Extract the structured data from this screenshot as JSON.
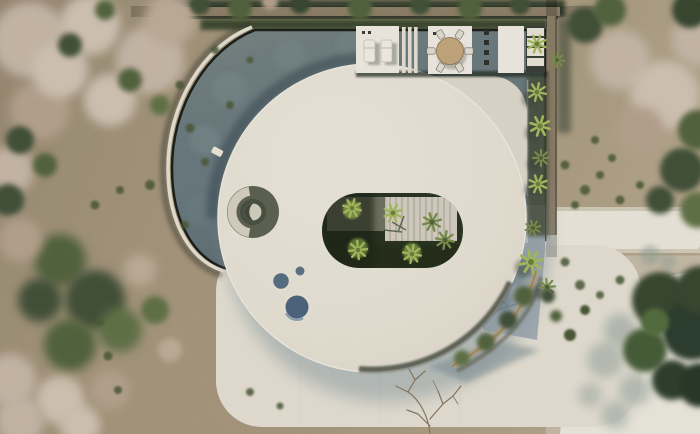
{
  "scene": {
    "description": "Aerial top-down 3D render of a modern round white villa with a curved infinity pool wrapping its left side, a central oval palm courtyard cut into the roof, a sun deck with loungers and a round dining table, a stepping-slab walkway to the east, stone perimeter walls, and dry sandy terrain with scrub and palm vegetation.",
    "labels": {
      "pool": "curved-infinity-pool",
      "roof_circle": "circular-white-roof",
      "roof_wing": "roof-wing-section",
      "courtyard": "oval-palm-courtyard",
      "lightwell": "circular-roof-lightwell",
      "skylights": "round-skylights",
      "deck": "pool-deck",
      "loungers": "sun-loungers",
      "dining": "round-dining-table-with-chairs",
      "steps": "deck-steps",
      "walkway": "stepping-slab-walkway",
      "paving": "blue-grey-paving",
      "terrace": "lower-terrace",
      "plaza": "white-garden-path",
      "wall_top": "perimeter-stone-wall",
      "wall_side": "east-stone-wall",
      "wall_curved": "curved-garden-wall",
      "palms": "palm-trees",
      "terrain": "sandy-scrub-terrain",
      "bare_tree": "leafless-tree",
      "big_tree": "dark-green-tree-canopy"
    },
    "palette": {
      "sand": "#b7a78a",
      "sand_light": "#c6b698",
      "pool_water": "#51646b",
      "pool_water_dark": "#3c4f59",
      "pool_rim": "#1d201b",
      "pool_coping": "#e9e4d6",
      "roof": "#ebe5d8",
      "roof_secondary": "#e2dccf",
      "terrace": "#e8e3d6",
      "plaza": "#ece7da",
      "shadow": "#8fa0a6",
      "paving": "#a6afb7",
      "stone": "#b1a083",
      "hedge": "#3f4c33",
      "canopy_dry": "#cbbbab",
      "canopy_green": "#55663f",
      "palm_bright": "#a9bd62",
      "courtyard_floor": "#2c3623",
      "skylight_glass": "#4f6781",
      "table_wood": "#c7a97e",
      "furniture": "#f3efe6",
      "soil_dark": "#4a4f3e"
    }
  }
}
